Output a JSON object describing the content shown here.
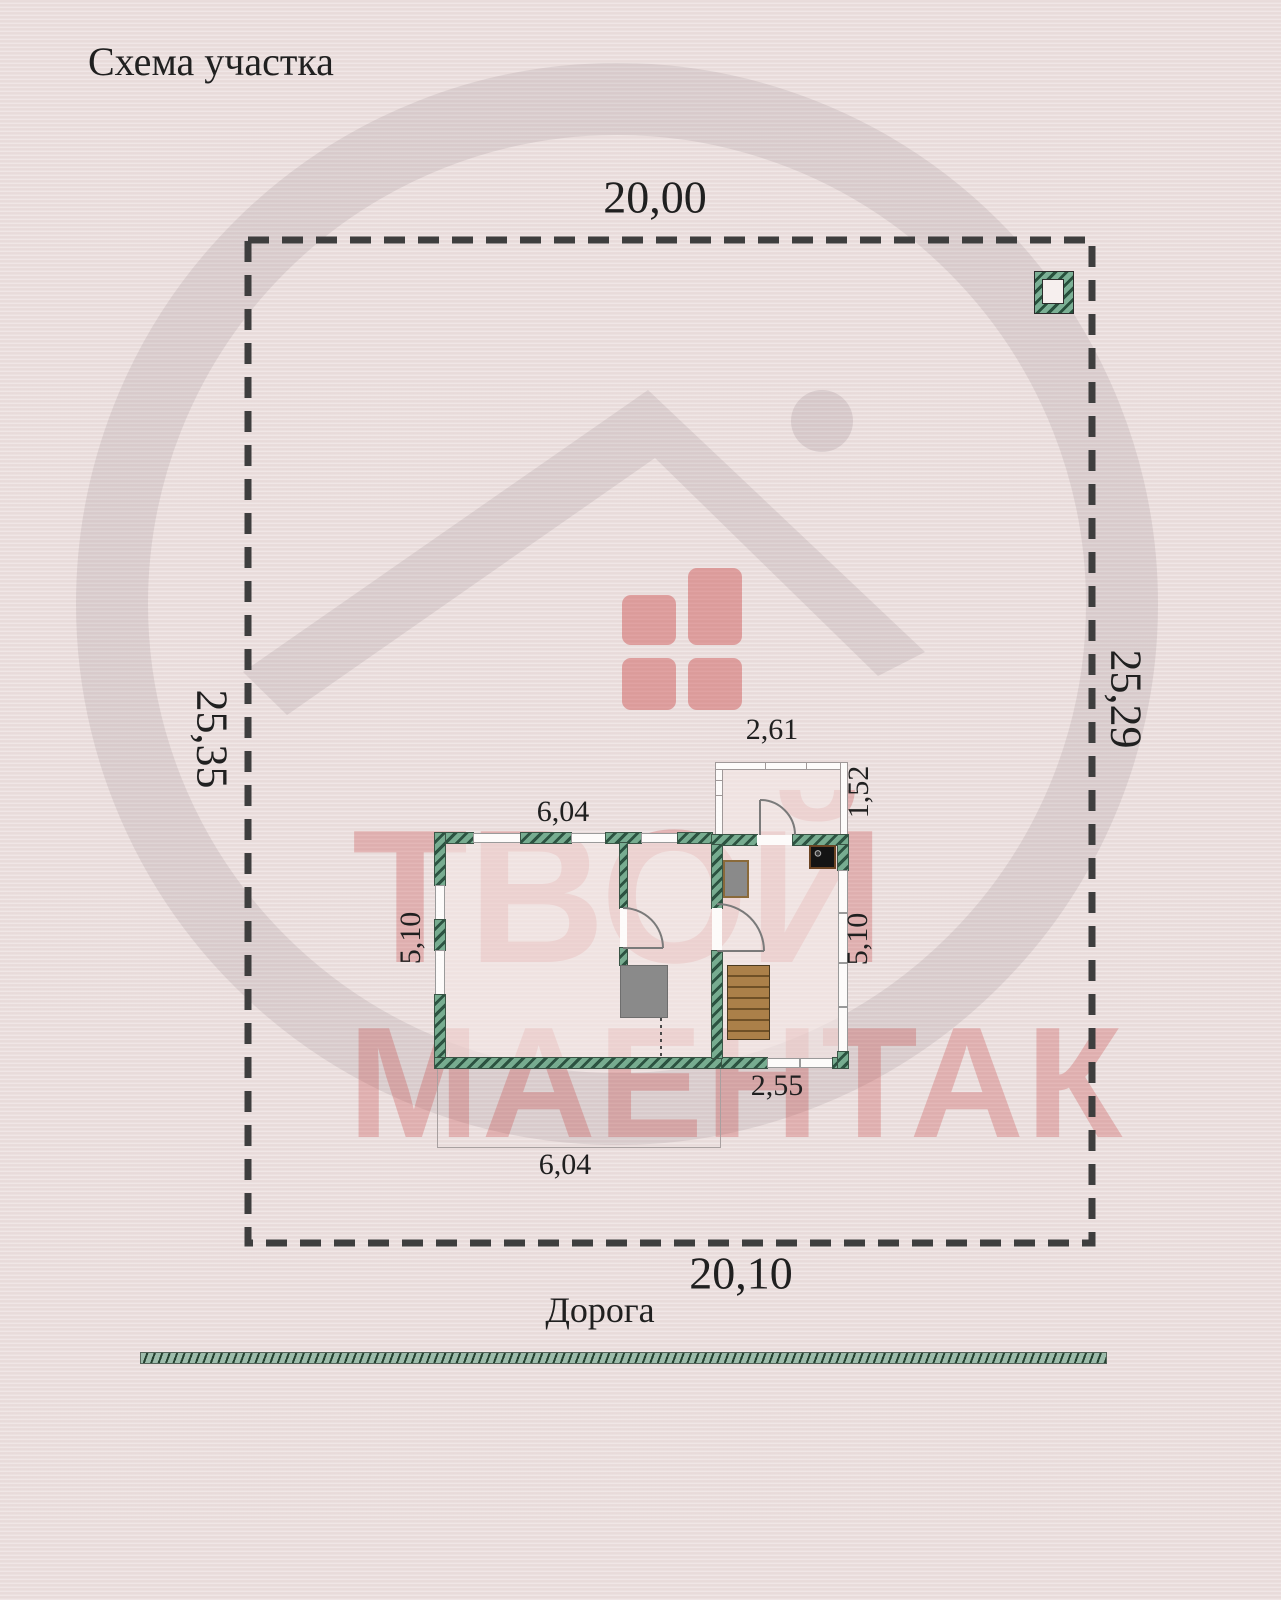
{
  "title": "Схема участка",
  "plot": {
    "width_top": "20,00",
    "width_bottom": "20,10",
    "height_left": "25,35",
    "height_right": "25,29",
    "road_label": "Дорога"
  },
  "house": {
    "main_width_top": "6,04",
    "main_height_left": "5,10",
    "wing_height_right": "5,10",
    "wing_width_bottom": "2,55",
    "annex_width": "2,61",
    "annex_height": "1,52",
    "terrace_width": "6,04"
  },
  "watermark": {
    "line1": "ТВОЙ",
    "line2": "МАЕНТАК"
  },
  "icons": [
    "stork-logo-icon",
    "house-windows-icon",
    "cooktop-icon",
    "stairs-icon",
    "well-icon"
  ],
  "colors": {
    "background": "#e9dcdb",
    "boundary_dash": "#3e3e3e",
    "wall_green": "#77ac90",
    "wall_hatch_dark": "#2c5341",
    "stair_wood": "#ab8049",
    "furniture_gray": "#8a8a8a",
    "watermark_red": "#c63e3e",
    "watermark_gray": "#5f4655",
    "label_text": "#202020"
  }
}
